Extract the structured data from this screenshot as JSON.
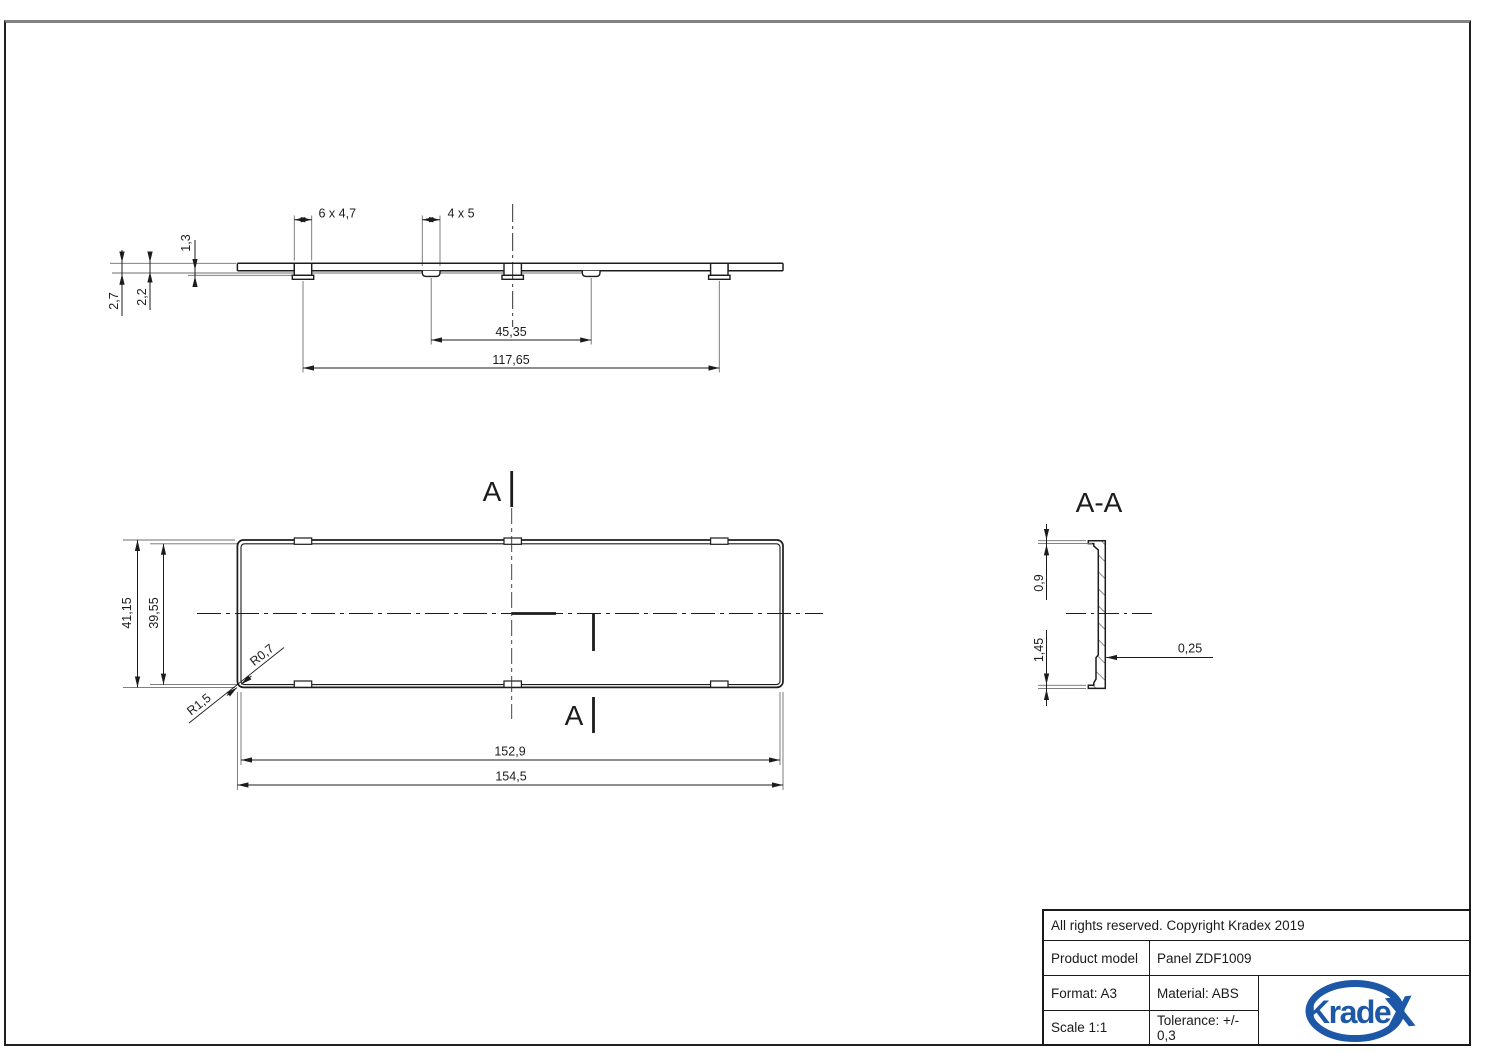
{
  "drawing": {
    "profile_view": {
      "dim_tab_large": "6 x 4,7",
      "dim_tab_small": "4 x 5",
      "dim_step": "1,3",
      "dim_thickness_cap": "2,2",
      "dim_thickness_total": "2,7",
      "dim_span_inner": "45,35",
      "dim_span_outer": "117,65"
    },
    "front_view": {
      "dim_height_outer": "41,15",
      "dim_height_inner": "39,55",
      "radius_inner": "R0,7",
      "radius_outer": "R1,5",
      "dim_width_inner": "152,9",
      "dim_width_outer": "154,5",
      "section_letter_top": "A",
      "section_letter_bottom": "A"
    },
    "section_view": {
      "title": "A-A",
      "dim_top_step": "0,9",
      "dim_bottom_step": "1,45",
      "dim_wall": "0,25"
    }
  },
  "title_block": {
    "copyright": "All rights reserved. Copyright Kradex 2019",
    "product_model_label": "Product model",
    "product_model_value": "Panel ZDF1009",
    "format": "Format: A3",
    "material": "Material: ABS",
    "scale": "Scale 1:1",
    "tolerance": "Tolerance: +/- 0,3",
    "logo_text": "Krade",
    "logo_x": "X"
  },
  "colors": {
    "line": "#1c1c1c",
    "ext_line": "#6e6e6e",
    "logo_blue": "#1d58a8"
  }
}
